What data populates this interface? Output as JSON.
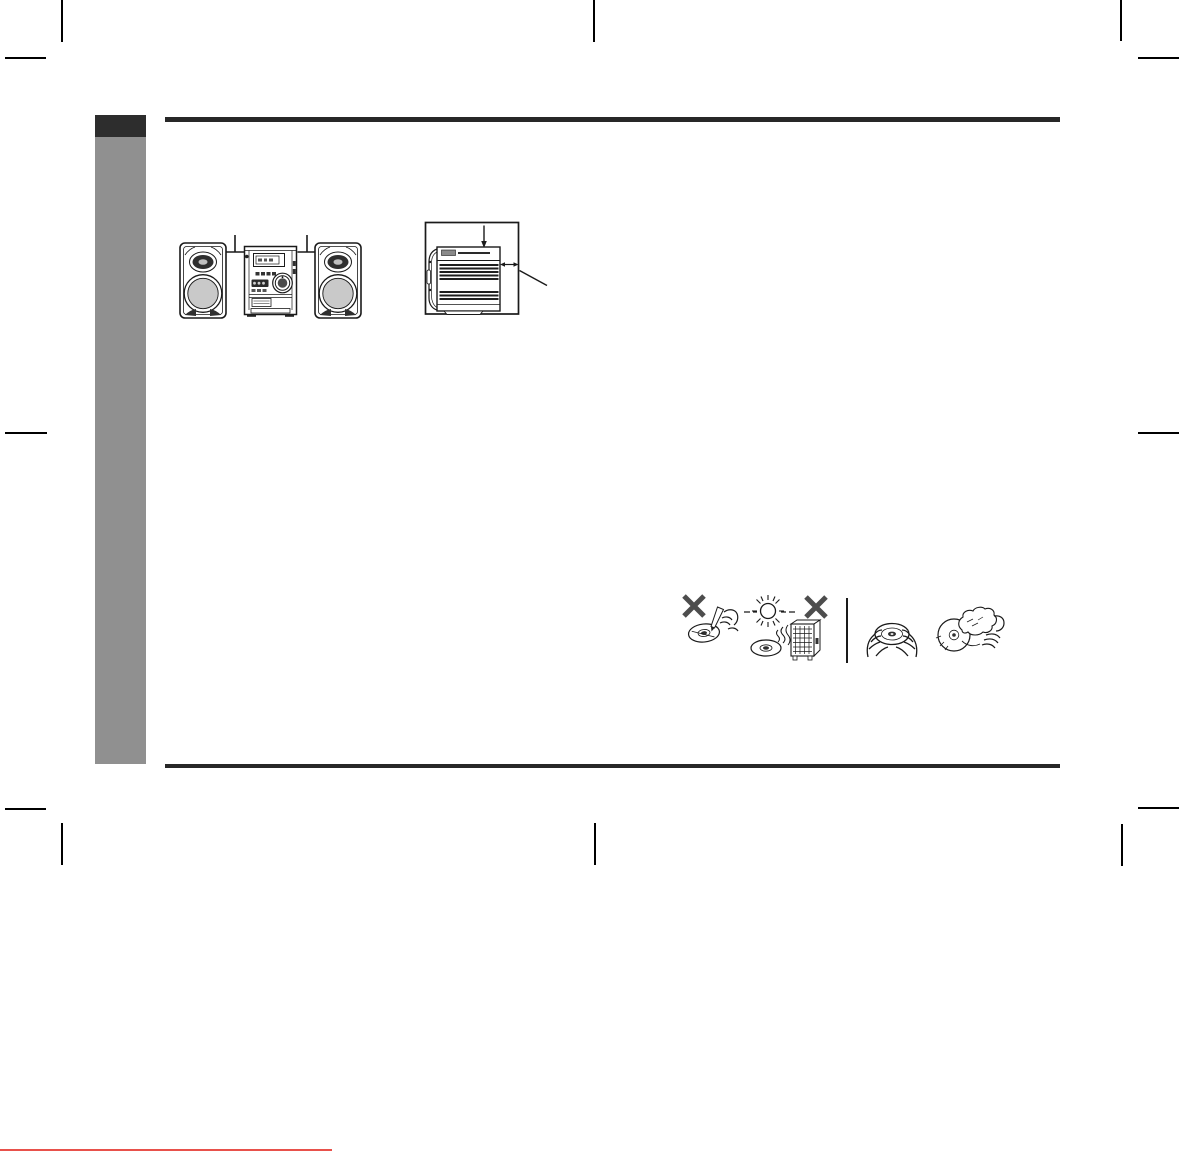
{
  "colors": {
    "page_bg": "#ffffff",
    "tab_dark": "#2d2d2d",
    "sidebar_gray": "#909090",
    "rule_dark": "#282828",
    "crop_mark": "#000000",
    "ink": "#1a1a1a",
    "cone_gray": "#c9c9c9",
    "x_gray": "#4d4d4d",
    "red_underline": "#e8514b"
  },
  "illustrations": {
    "front_view": "mini-system-front-view-with-speakers",
    "side_view": "main-unit-side-view-ventilation-clearance",
    "disc_care_icons": [
      "no-writing-on-disc-icon",
      "no-sunlight-or-heater-icon",
      "hold-disc-by-edges-icon",
      "wipe-disc-with-cloth-icon"
    ]
  }
}
